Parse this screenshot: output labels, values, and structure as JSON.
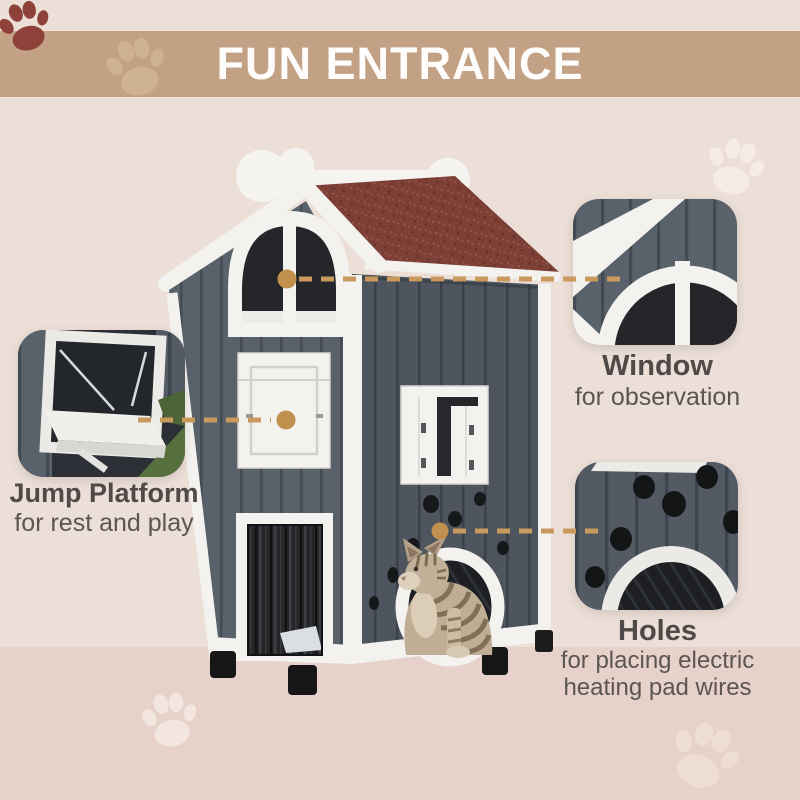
{
  "banner": {
    "title": "FUN ENTRANCE"
  },
  "callouts": [
    {
      "id": "window",
      "title": "Window",
      "description": "for observation"
    },
    {
      "id": "jump-platform",
      "title": "Jump Platform",
      "description": "for rest and play"
    },
    {
      "id": "holes",
      "title": "Holes",
      "description": "for placing electric heating pad wires"
    }
  ],
  "icons": {
    "paw": "paw-icon"
  },
  "colors": {
    "banner": "#c3a185",
    "background_top": "#ebdfd8",
    "background_bottom": "#e6d2ca",
    "connector_dash": "#c9995e",
    "connector_dot": "#c2904e",
    "roof": "#7c3f36",
    "house_front_gray": "#59616b",
    "house_side_gray": "#4e555e",
    "trim_white": "#f3f2ef",
    "brand_paw": "#8d4138",
    "label_title": "#4f4a47",
    "label_text": "#5c5550"
  }
}
